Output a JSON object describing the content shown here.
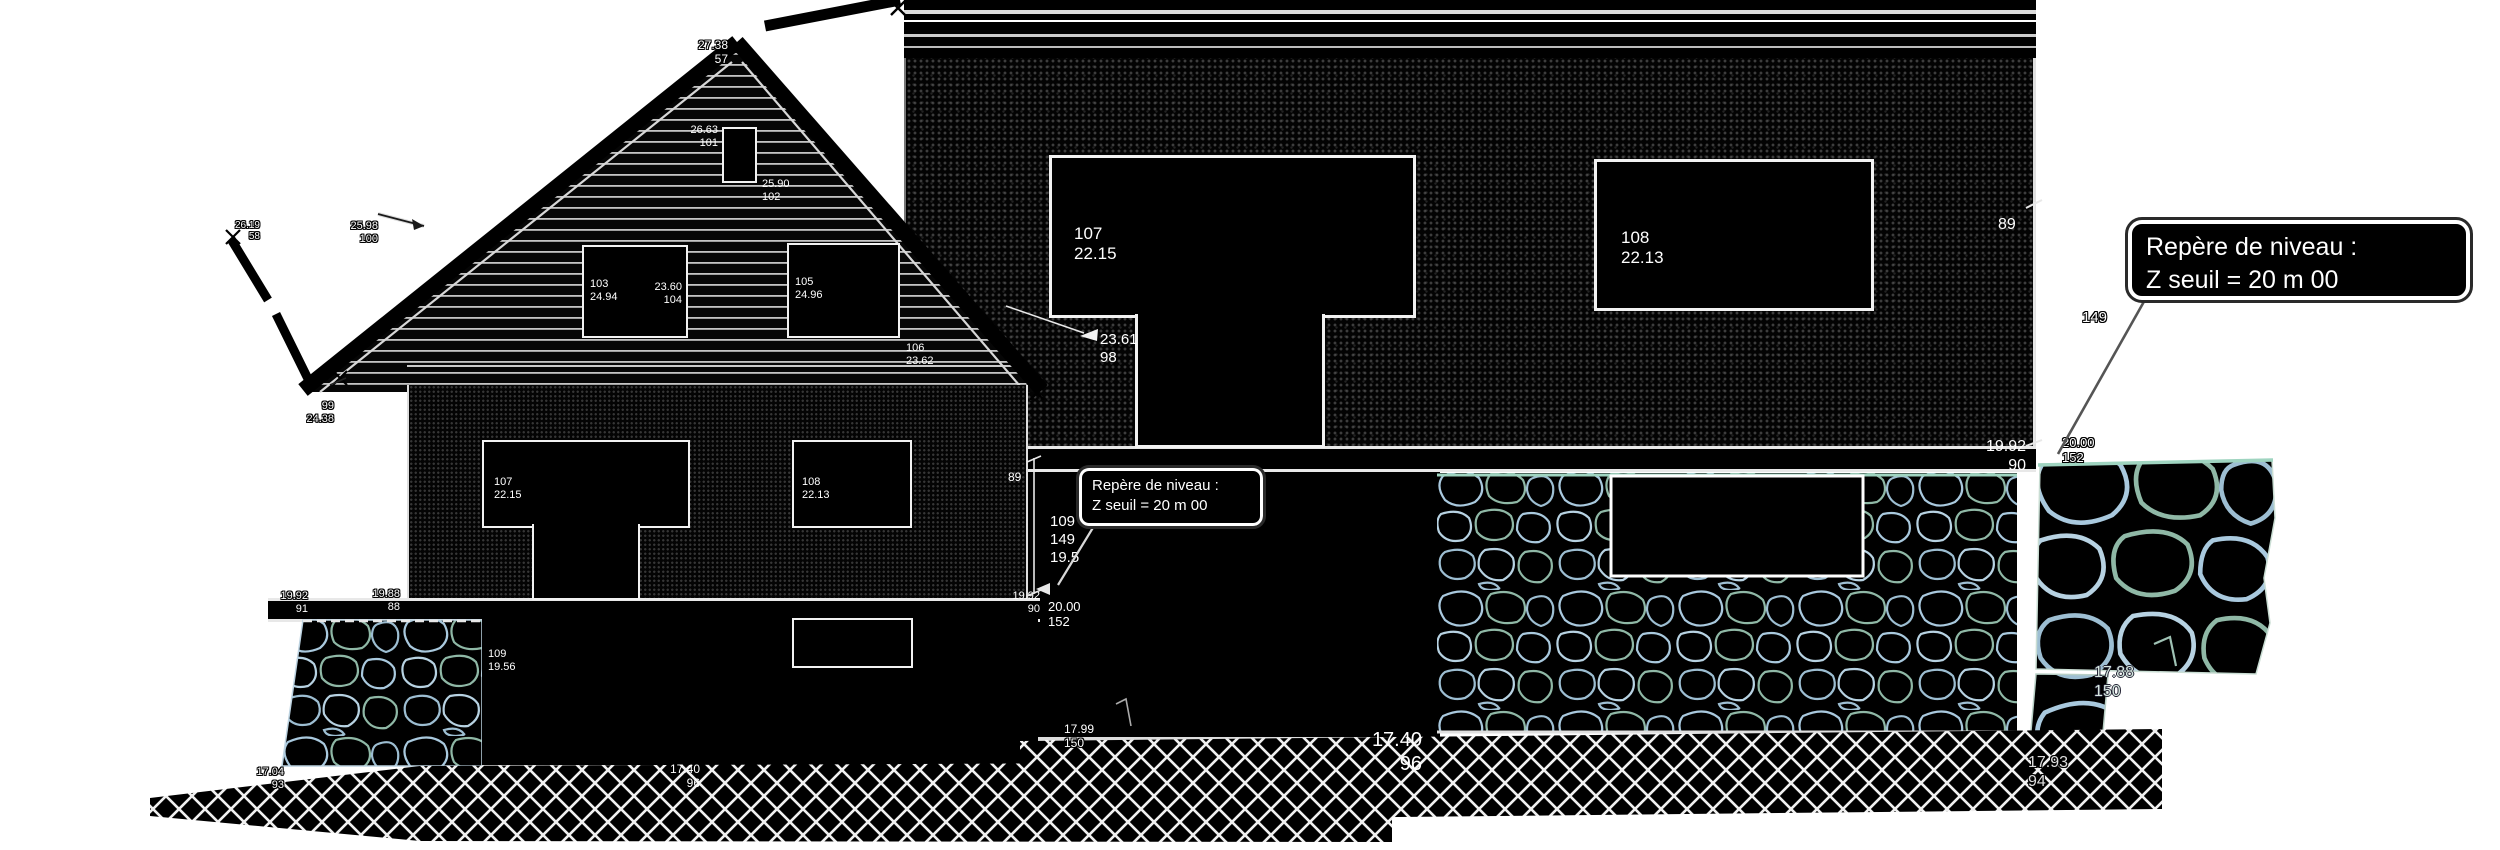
{
  "callout_small": {
    "line1": "Repère de niveau :",
    "line2": "Z seuil = 20 m 00"
  },
  "callout_large": {
    "line1": "Repère de niveau :",
    "line2": "Z seuil = 20 m 00"
  },
  "small": {
    "ridge_value": "27.38",
    "ridge_point": "57",
    "verge_value": "26.19",
    "verge_point": "58",
    "attic_top_value": "26.63",
    "attic_top_point": "101",
    "attic_sill_value": "25.90",
    "attic_sill_point": "102",
    "eaves_value": "25.98",
    "eaves_point": "100",
    "tip_point": "99",
    "tip_value": "24.38",
    "w103_point": "103",
    "w103_value": "24.94",
    "w103_sill_value": "23.60",
    "w103_sill_point": "104",
    "w105_point": "105",
    "w105_value": "24.96",
    "w105_sill_point": "106",
    "w105_sill_value": "23.62",
    "w107_point": "107",
    "w107_value": "22.15",
    "w108_point": "108",
    "w108_value": "22.13",
    "dim": "89",
    "slab_r_value": "19.92",
    "slab_r_point": "90",
    "slab_l1_value": "19.92",
    "slab_l1_point": "91",
    "slab_l2_value": "19.88",
    "slab_l2_point": "88",
    "bsmt_point": "109",
    "bsmt_value": "19.56",
    "grnd_value": "17.40",
    "grnd_point": "96",
    "grnd_l_value": "17.04",
    "grnd_l_point": "93"
  },
  "large": {
    "w107_point": "107",
    "w107_value": "22.15",
    "door_value": "23.61",
    "door_point": "98",
    "w108_point": "108",
    "w108_value": "22.13",
    "dim": "89",
    "point_149": "149",
    "slab_value": "19.92",
    "slab_point": "90",
    "bsmt_point": "109",
    "bsmt_point2": "149",
    "bsmt_value": "19.5",
    "level_value": "20.00",
    "level_point": "152",
    "level_r_value": "20.00",
    "level_r_point": "152",
    "grnd_value": "17.40",
    "grnd_point": "96",
    "mid_value": "17.99",
    "mid_point": "150",
    "stone_value": "17.88",
    "stone_point": "150",
    "far_value": "17.93",
    "far_point": "94"
  }
}
